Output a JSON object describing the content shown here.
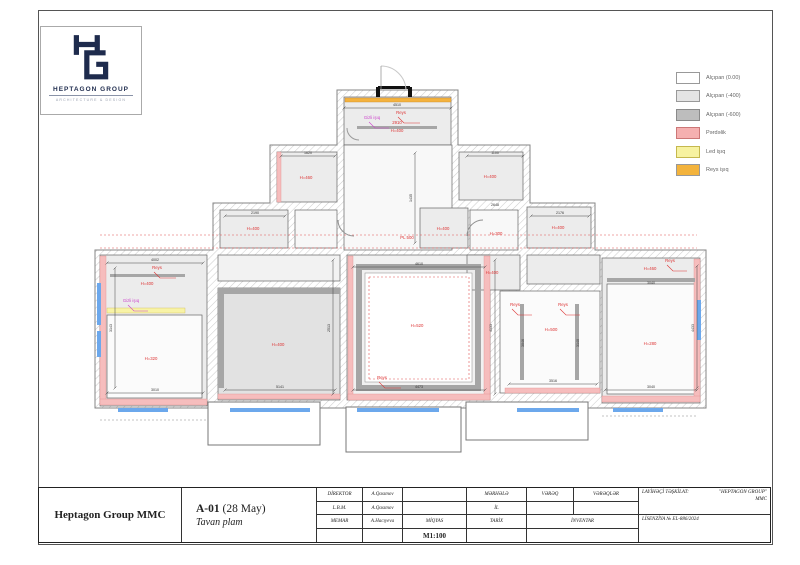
{
  "logo": {
    "name": "HEPTAGON GROUP",
    "subtitle": "ARCHITECTURE & DESIGN",
    "color": "#1e2b4d"
  },
  "legend": {
    "items": [
      {
        "label": "Alçıpan (0.00)",
        "color": "#ffffff",
        "border": "#999999"
      },
      {
        "label": "Alçıpan (-400)",
        "color": "#e4e4e4",
        "border": "#999999"
      },
      {
        "label": "Alçıpan (-600)",
        "color": "#bdbdbd",
        "border": "#8a8a8a"
      },
      {
        "label": "Pərdəlik",
        "color": "#f5b0b0",
        "border": "#cc7777"
      },
      {
        "label": "Led işıq",
        "color": "#f7f2a0",
        "border": "#c5b84e"
      },
      {
        "label": "Reys işıq",
        "color": "#f3b33c",
        "border": "#c US8;b"
      }
    ]
  },
  "titleblock": {
    "company": "Heptagon Group MMC",
    "sheet": {
      "code": "A-01",
      "date": " (28 May)",
      "name": "Tavan plam"
    },
    "rows": [
      {
        "role": "DİREKTOR",
        "name": "A.Qasımov"
      },
      {
        "role": "L.B.M.",
        "name": "A.Qasımov"
      },
      {
        "role": "MEMAR",
        "name": "A.Hacıyeva"
      }
    ],
    "scale_label": "MİQYAS",
    "scale_value": "M1:100",
    "stage_label": "MƏRHƏLƏ",
    "year_label": "İL",
    "date_label": "TARİX",
    "sheet_label": "VƏRƏQ",
    "sheets_label": "VƏRƏQLƏR",
    "inventory_label": "İNVENTAR",
    "designer_label": "LAYİHƏÇİ TƏŞKİLAT:",
    "designer_value": "\"HEPTAGON GROUP\"\nMMC",
    "license": "LİSENZİYA № EL-886/2024"
  },
  "plan": {
    "outline": "M252,12 H373 V67 H445 V125 H510 V172 H621 V330 H10 V172 H128 V125 H185 V67 H252 Z",
    "protrusions": [
      [
        123,
        324,
        112,
        43
      ],
      [
        261,
        329,
        115,
        45
      ],
      [
        381,
        324,
        122,
        38
      ]
    ],
    "rooms": [
      [
        259,
        19,
        107,
        48,
        "#ececec"
      ],
      [
        259,
        67,
        108,
        105,
        "#f8f8f8"
      ],
      [
        192,
        74,
        60,
        50,
        "#ececec"
      ],
      [
        374,
        74,
        64,
        48,
        "#ececec"
      ],
      [
        135,
        132,
        68,
        38,
        "#ececec"
      ],
      [
        210,
        132,
        42,
        38,
        "#f7f7f7"
      ],
      [
        442,
        129,
        64,
        41,
        "#ececec"
      ],
      [
        335,
        130,
        48,
        40,
        "#ececec"
      ],
      [
        385,
        132,
        48,
        40,
        "#f8f8f8"
      ],
      [
        15,
        177,
        107,
        151,
        "#ececec"
      ],
      [
        22,
        237,
        95,
        83,
        "#fbfbfb"
      ],
      [
        133,
        177,
        122,
        26,
        "#f2f2f2"
      ],
      [
        133,
        210,
        122,
        112,
        "#e2e2e2"
      ],
      [
        262,
        177,
        143,
        145,
        "#f1f1f1"
      ],
      [
        382,
        177,
        53,
        35,
        "#ececec"
      ],
      [
        442,
        177,
        73,
        29,
        "#ececec"
      ],
      [
        415,
        213,
        100,
        102,
        "#fbfbfb"
      ],
      [
        517,
        180,
        98,
        145,
        "#ececec"
      ],
      [
        522,
        206,
        88,
        110,
        "#fbfbfb"
      ]
    ],
    "strips": [
      [
        15,
        178,
        6,
        148,
        "pink"
      ],
      [
        15,
        321,
        107,
        6,
        "pink"
      ],
      [
        192,
        74,
        4,
        50,
        "pink"
      ],
      [
        263,
        178,
        5,
        143,
        "pink"
      ],
      [
        399,
        178,
        6,
        143,
        "pink"
      ],
      [
        263,
        316,
        142,
        6,
        "pink"
      ],
      [
        133,
        316,
        122,
        5,
        "pink"
      ],
      [
        420,
        310,
        95,
        5,
        "pink"
      ],
      [
        609,
        181,
        6,
        142,
        "pink"
      ],
      [
        517,
        318,
        98,
        6,
        "pink"
      ],
      [
        22,
        230,
        78,
        5,
        "yellow"
      ],
      [
        260,
        20,
        106,
        4,
        "orange"
      ],
      [
        274,
        189,
        119,
        121,
        "frame"
      ],
      [
        280,
        195,
        107,
        109,
        "white"
      ],
      [
        522,
        200,
        88,
        4,
        "dark"
      ],
      [
        435,
        226,
        4,
        76,
        "dark"
      ],
      [
        490,
        226,
        4,
        76,
        "dark"
      ],
      [
        272,
        48,
        80,
        3,
        "dark"
      ],
      [
        25,
        196,
        75,
        3,
        "dark"
      ],
      [
        133,
        210,
        122,
        6,
        "dark"
      ],
      [
        133,
        210,
        6,
        100,
        "dark"
      ],
      [
        12,
        205,
        4,
        42,
        "blue"
      ],
      [
        12,
        253,
        4,
        26,
        "blue"
      ],
      [
        33,
        330,
        50,
        4,
        "blue"
      ],
      [
        145,
        330,
        80,
        4,
        "blue"
      ],
      [
        272,
        330,
        82,
        4,
        "blue"
      ],
      [
        432,
        330,
        62,
        4,
        "blue"
      ],
      [
        528,
        330,
        50,
        4,
        "blue"
      ],
      [
        612,
        222,
        4,
        40,
        "blue"
      ],
      [
        293,
        8,
        32,
        3,
        "black"
      ],
      [
        291,
        9,
        4,
        10,
        "black"
      ],
      [
        323,
        9,
        4,
        10,
        "black"
      ]
    ],
    "dashes": [
      [
        15,
        157,
        612,
        157,
        "red"
      ],
      [
        15,
        170,
        612,
        170,
        "red"
      ],
      [
        284,
        199,
        384,
        199,
        "red"
      ],
      [
        284,
        301,
        384,
        301,
        "red"
      ],
      [
        284,
        199,
        284,
        301,
        "red"
      ],
      [
        384,
        199,
        384,
        301,
        "red"
      ],
      [
        15,
        342,
        122,
        342,
        "gray"
      ],
      [
        517,
        338,
        612,
        338,
        "gray"
      ]
    ],
    "dims": {
      "lines": [
        [
          259,
          30,
          366,
          30
        ],
        [
          196,
          78,
          250,
          78
        ],
        [
          382,
          78,
          438,
          78
        ],
        [
          140,
          138,
          200,
          138
        ],
        [
          446,
          138,
          504,
          138
        ],
        [
          22,
          185,
          118,
          185
        ],
        [
          268,
          189,
          400,
          189
        ],
        [
          22,
          315,
          118,
          315
        ],
        [
          140,
          312,
          250,
          312
        ],
        [
          268,
          312,
          400,
          312
        ],
        [
          424,
          306,
          512,
          306
        ],
        [
          520,
          312,
          612,
          312
        ],
        [
          30,
          190,
          30,
          310
        ],
        [
          248,
          182,
          248,
          316
        ],
        [
          410,
          182,
          410,
          316
        ],
        [
          612,
          188,
          612,
          310
        ],
        [
          330,
          75,
          330,
          165
        ]
      ],
      "texts": [
        {
          "t": "4510",
          "x": 312,
          "y": 28
        },
        {
          "t": "1620",
          "x": 223,
          "y": 76
        },
        {
          "t": "1100",
          "x": 410,
          "y": 76
        },
        {
          "t": "2190",
          "x": 170,
          "y": 136
        },
        {
          "t": "2176",
          "x": 475,
          "y": 136
        },
        {
          "t": "2648",
          "x": 410,
          "y": 128
        },
        {
          "t": "4002",
          "x": 70,
          "y": 183
        },
        {
          "t": "4610",
          "x": 334,
          "y": 187
        },
        {
          "t": "3010",
          "x": 70,
          "y": 313
        },
        {
          "t": "5141",
          "x": 195,
          "y": 310
        },
        {
          "t": "4473",
          "x": 334,
          "y": 310
        },
        {
          "t": "3516",
          "x": 468,
          "y": 304
        },
        {
          "t": "3040",
          "x": 566,
          "y": 310
        },
        {
          "t": "3040",
          "x": 566,
          "y": 206
        },
        {
          "t": "3143",
          "x": 27,
          "y": 250,
          "r": -90
        },
        {
          "t": "2513",
          "x": 245,
          "y": 250,
          "r": -90
        },
        {
          "t": "4133",
          "x": 407,
          "y": 250,
          "r": -90
        },
        {
          "t": "4433",
          "x": 609,
          "y": 250,
          "r": -90
        },
        {
          "t": "1435",
          "x": 327,
          "y": 120,
          "r": -90
        },
        {
          "t": "3046",
          "x": 439,
          "y": 265,
          "r": -90
        },
        {
          "t": "3140",
          "x": 494,
          "y": 265,
          "r": -90
        }
      ]
    },
    "labels": [
      {
        "t": "H=400",
        "x": 312,
        "y": 54,
        "c": "red"
      },
      {
        "t": "2910",
        "x": 312,
        "y": 46,
        "c": "red"
      },
      {
        "t": "H=460",
        "x": 221,
        "y": 101,
        "c": "red"
      },
      {
        "t": "H=400",
        "x": 405,
        "y": 100,
        "c": "red"
      },
      {
        "t": "H=400",
        "x": 168,
        "y": 152,
        "c": "red"
      },
      {
        "t": "H=400",
        "x": 473,
        "y": 151,
        "c": "red"
      },
      {
        "t": "H=400",
        "x": 358,
        "y": 152,
        "c": "red"
      },
      {
        "t": "H=300",
        "x": 411,
        "y": 157,
        "c": "red"
      },
      {
        "t": "PL 500",
        "x": 322,
        "y": 161,
        "c": "red"
      },
      {
        "t": "H=400",
        "x": 62,
        "y": 207,
        "c": "red"
      },
      {
        "t": "H=320",
        "x": 66,
        "y": 282,
        "c": "red"
      },
      {
        "t": "H=400",
        "x": 193,
        "y": 268,
        "c": "red"
      },
      {
        "t": "H=520",
        "x": 332,
        "y": 249,
        "c": "red"
      },
      {
        "t": "H=400",
        "x": 407,
        "y": 196,
        "c": "red"
      },
      {
        "t": "H=500",
        "x": 466,
        "y": 253,
        "c": "red"
      },
      {
        "t": "H=460",
        "x": 565,
        "y": 192,
        "c": "red"
      },
      {
        "t": "H=280",
        "x": 565,
        "y": 267,
        "c": "red"
      },
      {
        "t": "Reys",
        "x": 316,
        "y": 36,
        "c": "red"
      },
      {
        "t": "Reys",
        "x": 72,
        "y": 191,
        "c": "red"
      },
      {
        "t": "Reys",
        "x": 430,
        "y": 228,
        "c": "red"
      },
      {
        "t": "Reys",
        "x": 478,
        "y": 228,
        "c": "red"
      },
      {
        "t": "Reys",
        "x": 297,
        "y": 301,
        "c": "red"
      },
      {
        "t": "Reys",
        "x": 585,
        "y": 184,
        "c": "red"
      },
      {
        "t": "Gizli işıq",
        "x": 287,
        "y": 41,
        "c": "mag"
      },
      {
        "t": "Gizli işıq",
        "x": 46,
        "y": 224,
        "c": "mag"
      }
    ],
    "leaders": [
      {
        "p": "313,39 319,45 335,45",
        "c": "red"
      },
      {
        "p": "69,194 75,200 91,200",
        "c": "red"
      },
      {
        "p": "427,231 433,237 447,237",
        "c": "red"
      },
      {
        "p": "475,231 481,237 495,237",
        "c": "red"
      },
      {
        "p": "294,304 300,310 316,310",
        "c": "red"
      },
      {
        "p": "582,187 588,193 602,193",
        "c": "red"
      },
      {
        "p": "284,44 290,50 304,50",
        "c": "mag"
      },
      {
        "p": "43,227 49,233 63,233",
        "c": "mag"
      }
    ],
    "arcs": [
      {
        "d": "M253,142 A16,16 0 0 0 269,158",
        "c": "#8f8f8f"
      },
      {
        "d": "M382,158 A16,16 0 0 1 398,142",
        "c": "#8f8f8f"
      },
      {
        "d": "M262,50 A12,12 0 0 0 274,62",
        "c": "#9a9a9a"
      },
      {
        "d": "M296,-12 A25,25 0 0 1 321,12",
        "c": "#c8c8c8"
      }
    ],
    "door_leaf": [
      296,
      12,
      296,
      -12
    ]
  }
}
